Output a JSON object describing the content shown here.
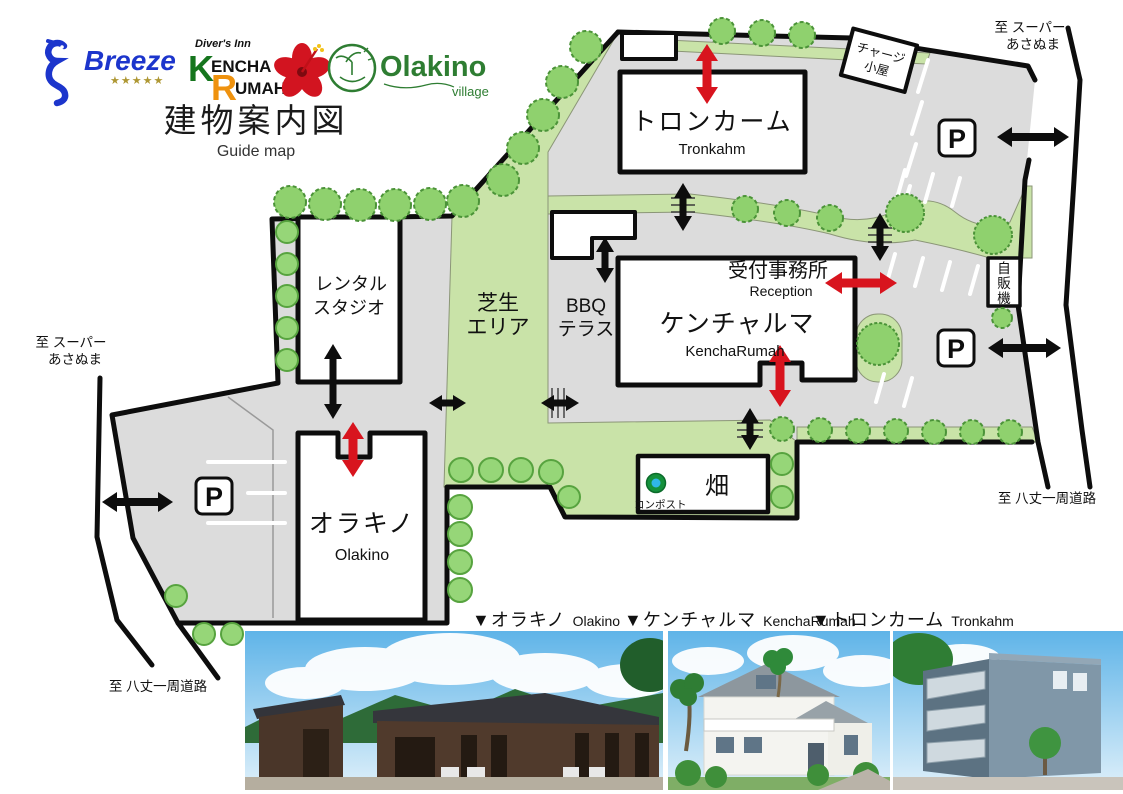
{
  "logos": {
    "breeze": "Breeze",
    "breeze_stars": "★★★★★",
    "divers_inn": "Diver's Inn",
    "kencha_k": "K",
    "kencha_encha": "ENCHA",
    "kencha_r": "R",
    "kencha_umah": "UMAH",
    "olakino": "Olakino",
    "olakino_village": "village"
  },
  "title": {
    "jp": "建物案内図",
    "en": "Guide map"
  },
  "map": {
    "tronkahm_jp": "トロンカーム",
    "tronkahm_en": "Tronkahm",
    "rental_1": "レンタル",
    "rental_2": "スタジオ",
    "kencharumah_jp": "ケンチャルマ",
    "kencharumah_en": "KenchaRumah",
    "reception_jp": "受付事務所",
    "reception_en": "Reception",
    "olakino_jp": "オラキノ",
    "olakino_en": "Olakino",
    "field": "畑",
    "compost": "コンポスト",
    "charge_1": "チャージ",
    "charge_2": "小屋",
    "vending_1": "自",
    "vending_2": "販",
    "vending_3": "機",
    "lawn_1": "芝生",
    "lawn_2": "エリア",
    "bbq_1": "BBQ",
    "bbq_2": "テラス",
    "parking": "P",
    "to_super_1": "至 スーパー",
    "to_super_2": "あさぬま",
    "to_loop": "至 八丈一周道路"
  },
  "photos": {
    "olakino_jp": "▼オラキノ",
    "olakino_en": "Olakino",
    "kencha_jp": "▼ケンチャルマ",
    "kencha_en": "KenchaRumah",
    "tron_jp": "▼トロンカーム",
    "tron_en": "Tronkahm"
  },
  "colors": {
    "map_gray": "#dcdcdc",
    "lawn_green": "#c9e3a8",
    "tree_green": "#8fd16e",
    "arrow_red": "#d8141e",
    "arrow_black": "#0d0d0d",
    "compost_blue": "#30b7ea",
    "breeze_blue": "#1c35cc",
    "kencha_green": "#15751d",
    "kencha_orange": "#ef920e",
    "olakino_green": "#2e7d32"
  }
}
